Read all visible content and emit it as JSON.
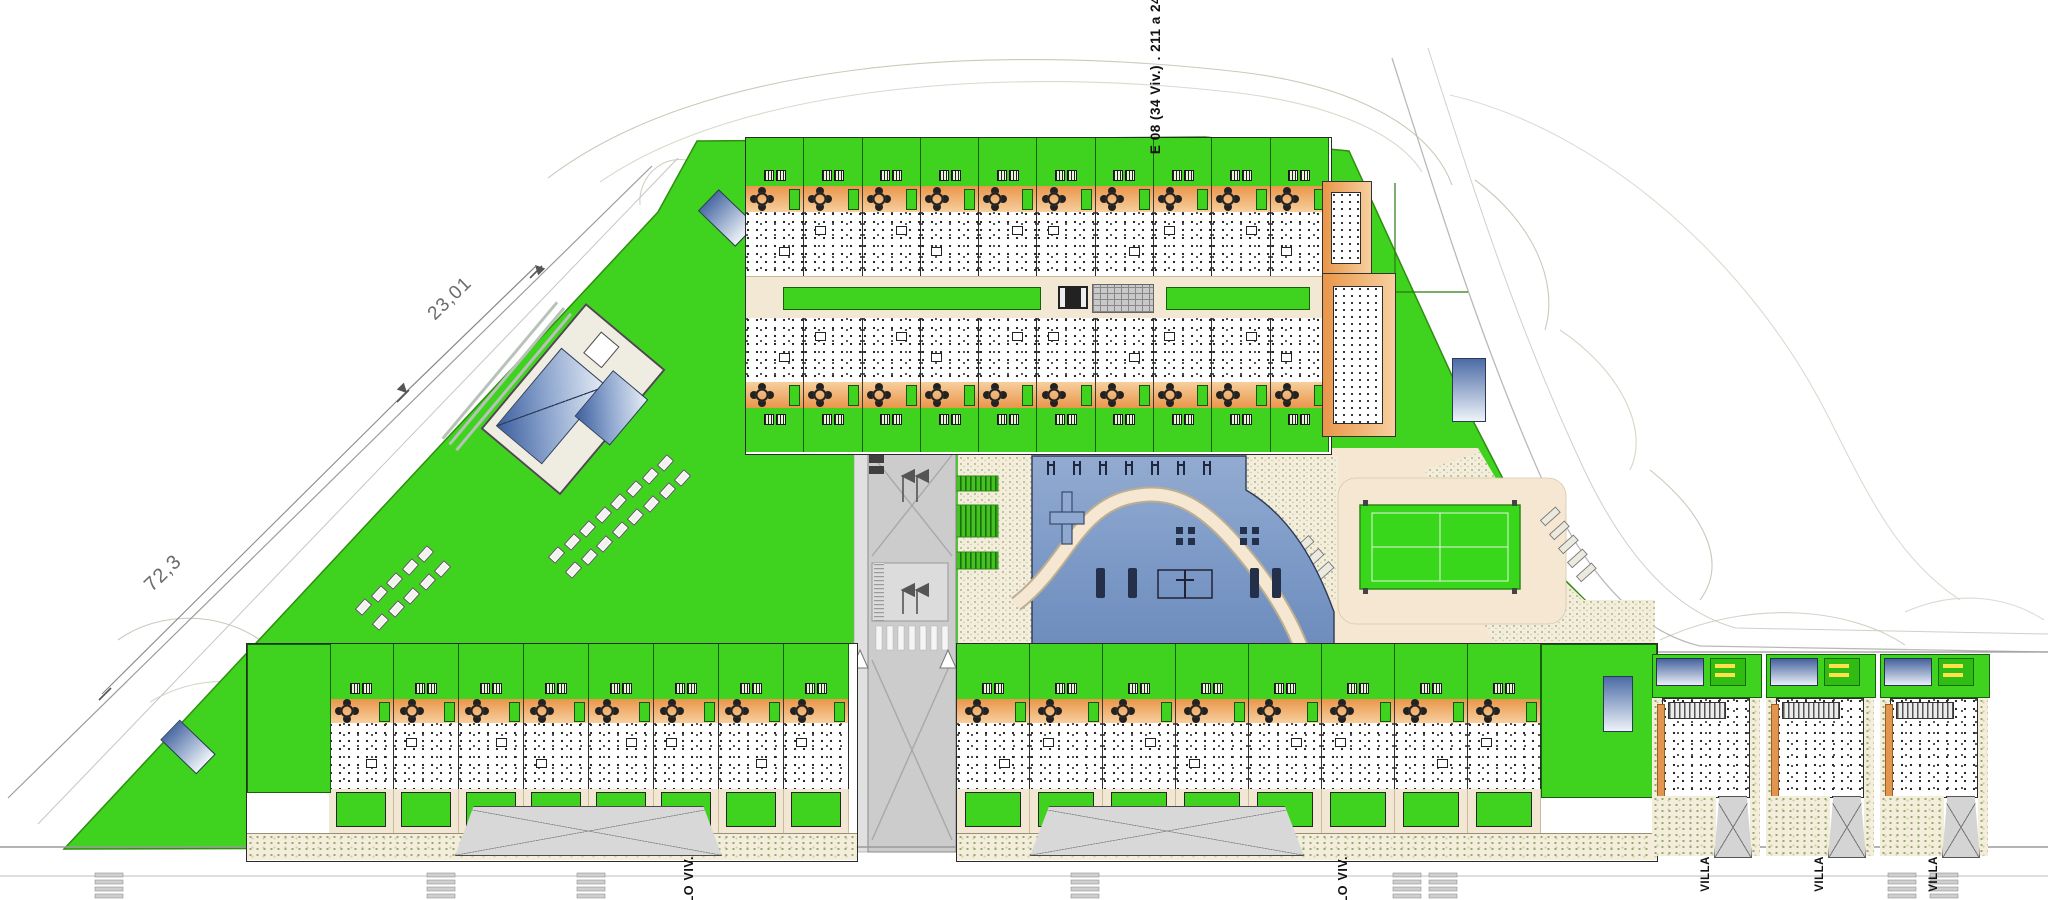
{
  "page": {
    "background": "#ffffff",
    "type": "residential site plan"
  },
  "labels": {
    "dimensions": [
      {
        "text": "23,01"
      },
      {
        "text": "72,3"
      }
    ],
    "top_block": {
      "line1": "E 08 (34 Viv.)",
      "line2": ". 211 a 244"
    },
    "bottom_blocks": [
      {
        "line1": "BLO",
        "line2": "VIV."
      },
      {
        "line1": "BLO",
        "line2": "VIV."
      }
    ],
    "villa_labels": [
      "VILLA",
      "VILLA",
      "VILLA"
    ]
  },
  "colors": {
    "lawn": "#3fd31f",
    "court": "#38d71c",
    "terrace": "#e9964a",
    "terrace_light": "#f7cf9e",
    "paving": "#f5e7d2",
    "stipple": "#93a86b",
    "pool": "#7e9bc8",
    "pool_dark": "#2c3a57",
    "roof": "#3d5f9e",
    "road": "#cccccc",
    "boundary": "#979797",
    "contour": "#c6ccba"
  },
  "counts": {
    "top_block_units": 10,
    "bottom_left_units": 8,
    "bottom_right_units": 8,
    "villas": 3,
    "pool_handrails": 7,
    "zebra_stripes": 7,
    "pergolas": 3,
    "parking_stalls_small": 3,
    "parking_stalls_diagonal": 5,
    "lounger_clusters": [
      {
        "cols": 8,
        "rows": 2
      },
      {
        "cols": 5,
        "rows": 2
      }
    ],
    "street_marker_stacks": 8
  }
}
